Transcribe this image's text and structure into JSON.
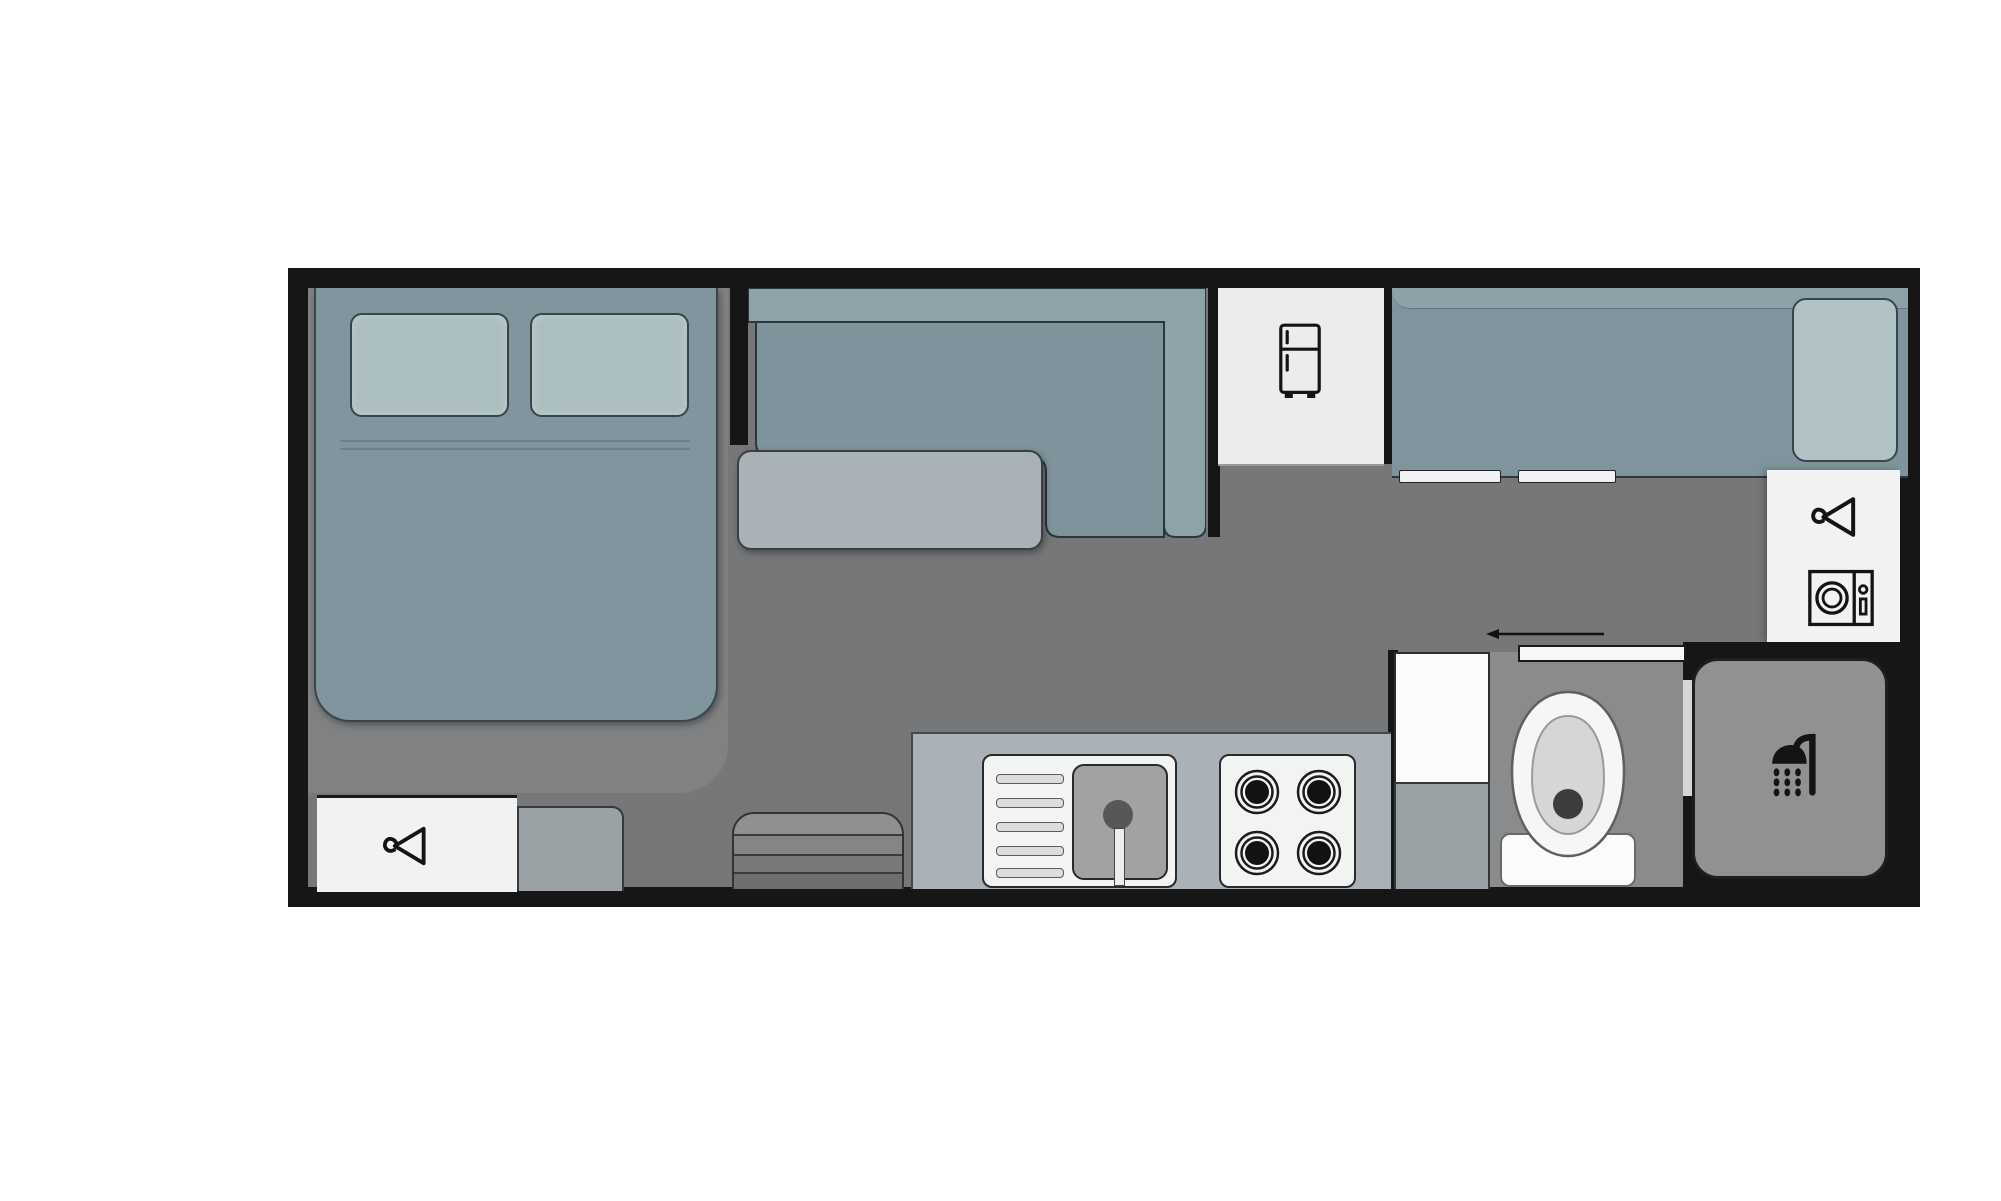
{
  "diagram": {
    "type": "floor-plan",
    "subject": "Caravan / RV interior layout, top-down view",
    "rooms": [
      {
        "name": "bedroom",
        "fixtures": [
          "double-bed",
          "pillow-left",
          "pillow-right",
          "wardrobe-with-hanger",
          "bedside-cabinet"
        ]
      },
      {
        "name": "dinette",
        "fixtures": [
          "l-shaped-sofa-seat",
          "sofa-backrest",
          "dinette-table"
        ]
      },
      {
        "name": "galley-kitchen",
        "fixtures": [
          "fridge-compartment",
          "kitchen-counter",
          "sink-with-drainer",
          "faucet",
          "four-burner-stove"
        ]
      },
      {
        "name": "lounge",
        "fixtures": [
          "long-sofa",
          "sofa-backrest-band",
          "end-cushion",
          "drawer-handle-left",
          "drawer-handle-right"
        ]
      },
      {
        "name": "utility-closet",
        "fixtures": [
          "wardrobe-with-hanger",
          "washing-machine"
        ]
      },
      {
        "name": "bathroom",
        "fixtures": [
          "vanity-unit",
          "vanity-cabinet",
          "toilet",
          "sliding-door",
          "door-direction-arrow"
        ]
      },
      {
        "name": "shower-room",
        "fixtures": [
          "shower-tray",
          "shower-head",
          "shower-screen"
        ]
      },
      {
        "name": "entry",
        "fixtures": [
          "entry-steps"
        ]
      }
    ],
    "icons": [
      "hanger-icon",
      "fridge-icon",
      "washing-machine-icon",
      "shower-icon"
    ],
    "palette": {
      "wall": "#161616",
      "floor_main": "#757779",
      "floor_bedroom": "#7f8183",
      "floor_bathroom": "#8a8b8d",
      "upholstery": "#80959d",
      "sofa_seat": "#7e939c",
      "backrest": "#8da2a9",
      "cushion": "#b0c2c3",
      "table": "#a9b2b6",
      "counter": "#abb2b7",
      "fixture_white": "#f1f2f2",
      "shower_tray": "#8f9193",
      "icon_stroke": "#141414",
      "background": "#ffffff"
    }
  }
}
